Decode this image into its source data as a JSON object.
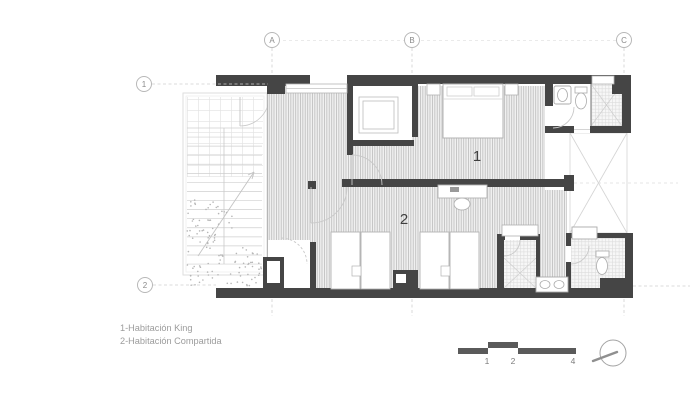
{
  "grid": {
    "cols": [
      {
        "label": "A"
      },
      {
        "label": "B"
      },
      {
        "label": "C"
      }
    ],
    "rows": [
      {
        "label": "1"
      },
      {
        "label": "2"
      }
    ]
  },
  "rooms": [
    {
      "label": "1",
      "name": "Habitación King"
    },
    {
      "label": "2",
      "name": "Habitación Compartida"
    }
  ],
  "legend": {
    "line1": "1-Habitación King",
    "line2": "2-Habitación Compartida"
  },
  "scale_bar": {
    "ticks": [
      "1",
      "2",
      "4"
    ]
  },
  "colors": {
    "wall": "#454545",
    "hatch_line": "#bcbcbc",
    "light_line": "#d6d6d6",
    "grid_text": "#8a8a8a",
    "room_text": "#3f3f3f",
    "legend_text": "#9c9c9c",
    "scale_bar": "#5a5a5a"
  }
}
